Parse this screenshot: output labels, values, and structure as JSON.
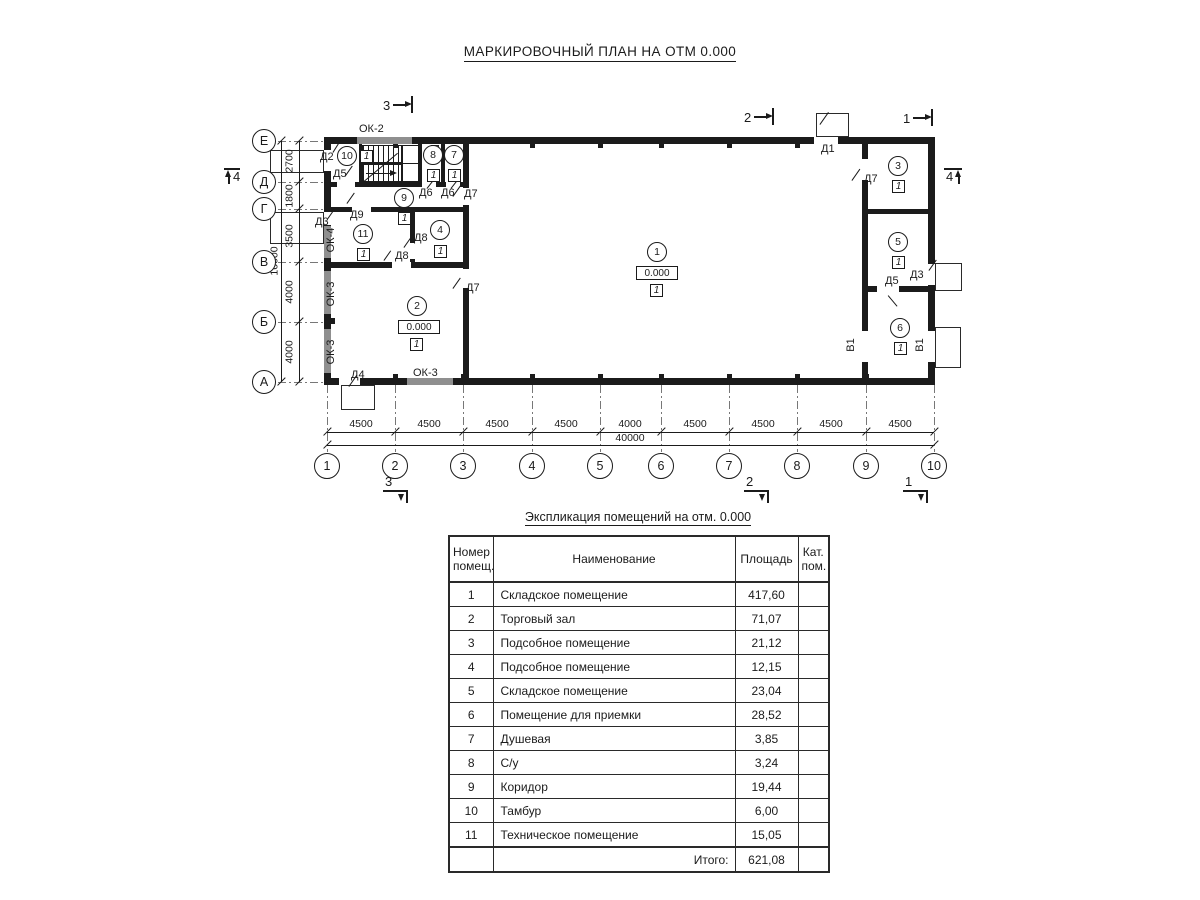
{
  "plan": {
    "title": "МАРКИРОВОЧНЫЙ ПЛАН НА ОТМ 0.000",
    "axes_rows": [
      {
        "label": "Е",
        "y": 141
      },
      {
        "label": "Д",
        "y": 182
      },
      {
        "label": "Г",
        "y": 209
      },
      {
        "label": "В",
        "y": 262
      },
      {
        "label": "Б",
        "y": 322
      },
      {
        "label": "А",
        "y": 382
      }
    ],
    "axes_cols": [
      {
        "label": "1",
        "x": 327
      },
      {
        "label": "2",
        "x": 395
      },
      {
        "label": "3",
        "x": 463
      },
      {
        "label": "4",
        "x": 532
      },
      {
        "label": "5",
        "x": 600
      },
      {
        "label": "6",
        "x": 661
      },
      {
        "label": "7",
        "x": 729
      },
      {
        "label": "8",
        "x": 797
      },
      {
        "label": "9",
        "x": 866
      },
      {
        "label": "10",
        "x": 934
      }
    ],
    "walls": [
      [
        324,
        137,
        611,
        7
      ],
      [
        324,
        378,
        611,
        7
      ],
      [
        324,
        137,
        7,
        248
      ],
      [
        928,
        137,
        7,
        248
      ],
      [
        463,
        137,
        6,
        248
      ],
      [
        862,
        137,
        6,
        248
      ],
      [
        324,
        182,
        145,
        5
      ],
      [
        324,
        207,
        145,
        5
      ],
      [
        324,
        262,
        145,
        6
      ],
      [
        410,
        212,
        5,
        50
      ],
      [
        418,
        143,
        4,
        39
      ],
      [
        441,
        143,
        4,
        39
      ],
      [
        359,
        143,
        3,
        39
      ],
      [
        862,
        209,
        73,
        5
      ],
      [
        862,
        286,
        73,
        6
      ]
    ],
    "windows": [
      [
        357,
        137,
        55,
        7
      ],
      [
        324,
        226,
        7,
        32
      ],
      [
        324,
        271,
        7,
        43
      ],
      [
        324,
        329,
        7,
        44
      ],
      [
        407,
        378,
        46,
        7
      ]
    ],
    "door_gaps": [
      [
        324,
        150,
        7,
        21
      ],
      [
        324,
        212,
        7,
        13
      ],
      [
        339,
        378,
        21,
        7
      ],
      [
        814,
        137,
        24,
        7
      ],
      [
        928,
        264,
        7,
        21
      ],
      [
        928,
        331,
        7,
        31
      ],
      [
        862,
        331,
        6,
        31
      ],
      [
        862,
        159,
        6,
        21
      ],
      [
        877,
        286,
        22,
        6
      ],
      [
        463,
        188,
        6,
        17
      ],
      [
        463,
        269,
        6,
        19
      ],
      [
        410,
        243,
        5,
        16
      ],
      [
        392,
        262,
        19,
        6
      ],
      [
        352,
        207,
        19,
        5
      ],
      [
        337,
        182,
        18,
        5
      ],
      [
        422,
        182,
        14,
        5
      ],
      [
        446,
        182,
        14,
        5
      ]
    ],
    "porches": [
      [
        270,
        150,
        54,
        23
      ],
      [
        270,
        212,
        54,
        32
      ],
      [
        341,
        385,
        34,
        25
      ],
      [
        816,
        113,
        33,
        24
      ],
      [
        935,
        263,
        27,
        28
      ],
      [
        935,
        327,
        26,
        41
      ]
    ],
    "fixtures": [
      [
        431,
        145,
        8,
        10
      ]
    ],
    "pilasters": [
      [
        393,
        144,
        5,
        4
      ],
      [
        530,
        144,
        5,
        4
      ],
      [
        598,
        144,
        5,
        4
      ],
      [
        659,
        144,
        5,
        4
      ],
      [
        727,
        144,
        5,
        4
      ],
      [
        795,
        144,
        5,
        4
      ],
      [
        393,
        374,
        5,
        4
      ],
      [
        461,
        374,
        5,
        4
      ],
      [
        530,
        374,
        5,
        4
      ],
      [
        598,
        374,
        5,
        4
      ],
      [
        659,
        374,
        5,
        4
      ],
      [
        727,
        374,
        5,
        4
      ],
      [
        795,
        374,
        5,
        4
      ],
      [
        864,
        374,
        5,
        4
      ],
      [
        331,
        318,
        4,
        6
      ]
    ],
    "leaves": [
      [
        333,
        152,
        15,
        -58
      ],
      [
        345,
        176,
        13,
        -55
      ],
      [
        347,
        203,
        13,
        -55
      ],
      [
        328,
        218,
        12,
        -55
      ],
      [
        404,
        247,
        12,
        -55
      ],
      [
        384,
        260,
        12,
        -55
      ],
      [
        427,
        188,
        11,
        -52
      ],
      [
        451,
        188,
        11,
        -52
      ],
      [
        453,
        196,
        13,
        -55
      ],
      [
        453,
        288,
        13,
        -55
      ],
      [
        349,
        386,
        14,
        -55
      ],
      [
        820,
        124,
        15,
        -55
      ],
      [
        852,
        180,
        14,
        -55
      ],
      [
        929,
        270,
        13,
        -55
      ],
      [
        888,
        295,
        14,
        50
      ],
      [
        364,
        181,
        44,
        -40
      ]
    ],
    "labels": [
      {
        "text": "Д2",
        "x": 320,
        "y": 151
      },
      {
        "text": "Д5",
        "x": 333,
        "y": 168
      },
      {
        "text": "Д9",
        "x": 350,
        "y": 209
      },
      {
        "text": "Д3",
        "x": 315,
        "y": 216
      },
      {
        "text": "Д4",
        "x": 351,
        "y": 369
      },
      {
        "text": "Д1",
        "x": 821,
        "y": 143
      },
      {
        "text": "Д7",
        "x": 464,
        "y": 188
      },
      {
        "text": "Д7",
        "x": 466,
        "y": 282
      },
      {
        "text": "Д7",
        "x": 864,
        "y": 173
      },
      {
        "text": "Д8",
        "x": 414,
        "y": 232
      },
      {
        "text": "Д8",
        "x": 395,
        "y": 250
      },
      {
        "text": "Д6",
        "x": 419,
        "y": 187
      },
      {
        "text": "Д6",
        "x": 441,
        "y": 187
      },
      {
        "text": "Д5",
        "x": 885,
        "y": 275
      },
      {
        "text": "Д3",
        "x": 910,
        "y": 269
      },
      {
        "text": "ОК-2",
        "x": 359,
        "y": 123
      },
      {
        "text": "ОК-3",
        "x": 413,
        "y": 367
      },
      {
        "text": "ОК-4",
        "x": 331,
        "y": 240,
        "rot": -90
      },
      {
        "text": "ОК-3",
        "x": 331,
        "y": 294,
        "rot": -90
      },
      {
        "text": "ОК-3",
        "x": 331,
        "y": 352,
        "rot": -90
      },
      {
        "text": "В1",
        "x": 851,
        "y": 345,
        "rot": -90
      },
      {
        "text": "В1",
        "x": 920,
        "y": 345,
        "rot": -90
      }
    ],
    "rooms": [
      {
        "num": "1",
        "cat": "1",
        "cx": 657,
        "cy": 252,
        "elev": "0.000",
        "ex": 636,
        "ey": 266,
        "sx": 650,
        "sy": 284
      },
      {
        "num": "2",
        "cat": "1",
        "cx": 417,
        "cy": 306,
        "elev": "0.000",
        "ex": 398,
        "ey": 320,
        "sx": 410,
        "sy": 338
      },
      {
        "num": "3",
        "cat": "1",
        "cx": 898,
        "cy": 166,
        "sx": 892,
        "sy": 180
      },
      {
        "num": "4",
        "cat": "1",
        "cx": 440,
        "cy": 230,
        "sx": 434,
        "sy": 245
      },
      {
        "num": "5",
        "cat": "1",
        "cx": 898,
        "cy": 242,
        "sx": 892,
        "sy": 256
      },
      {
        "num": "6",
        "cat": "1",
        "cx": 900,
        "cy": 328,
        "sx": 894,
        "sy": 342
      },
      {
        "num": "7",
        "cat": "1",
        "cx": 454,
        "cy": 155,
        "sx": 448,
        "sy": 169
      },
      {
        "num": "8",
        "cat": "1",
        "cx": 433,
        "cy": 155,
        "sx": 427,
        "sy": 169
      },
      {
        "num": "9",
        "cat": "1",
        "cx": 404,
        "cy": 198,
        "sx": 398,
        "sy": 212
      },
      {
        "num": "10",
        "cat": "1",
        "cx": 347,
        "cy": 156,
        "sx": 360,
        "sy": 150
      },
      {
        "num": "11",
        "cat": "1",
        "cx": 363,
        "cy": 234,
        "sx": 357,
        "sy": 248
      }
    ],
    "sections": [
      {
        "num": "3",
        "type": "top",
        "x": 383,
        "y": 96
      },
      {
        "num": "2",
        "type": "top",
        "x": 744,
        "y": 108
      },
      {
        "num": "1",
        "type": "top",
        "x": 903,
        "y": 109
      },
      {
        "num": "3",
        "type": "bottom",
        "x": 383,
        "y": 475
      },
      {
        "num": "2",
        "type": "bottom",
        "x": 744,
        "y": 475
      },
      {
        "num": "1",
        "type": "bottom",
        "x": 903,
        "y": 475
      },
      {
        "num": "4",
        "type": "left",
        "x": 224,
        "y": 166
      },
      {
        "num": "4",
        "type": "right",
        "x": 944,
        "y": 166
      }
    ],
    "dims_bottom": {
      "y": 432,
      "ty": 419,
      "x1": 327,
      "x2": 934,
      "labels": [
        {
          "text": "4500",
          "mid": 361
        },
        {
          "text": "4500",
          "mid": 429
        },
        {
          "text": "4500",
          "mid": 497
        },
        {
          "text": "4500",
          "mid": 566
        },
        {
          "text": "4000",
          "mid": 630
        },
        {
          "text": "4500",
          "mid": 695
        },
        {
          "text": "4500",
          "mid": 763
        },
        {
          "text": "4500",
          "mid": 831
        },
        {
          "text": "4500",
          "mid": 900
        }
      ]
    },
    "dim_overall_bottom": {
      "text": "40000",
      "y": 445,
      "x1": 327,
      "x2": 934,
      "tx": 630,
      "ty": 433
    },
    "dims_left": {
      "x": 299,
      "tx": 290,
      "y1": 141,
      "y2": 382,
      "labels": [
        {
          "text": "2700",
          "mid": 161
        },
        {
          "text": "1800",
          "mid": 196
        },
        {
          "text": "3500",
          "mid": 236
        },
        {
          "text": "4000",
          "mid": 292
        },
        {
          "text": "4000",
          "mid": 352
        }
      ]
    },
    "dim_overall_left": {
      "text": "16000",
      "x": 281,
      "y1": 141,
      "y2": 382,
      "tx": 275,
      "tmid": 261
    },
    "stairs": {
      "x": 362,
      "y": 144
    }
  },
  "table": {
    "title": "Экспликация помещений на отм. 0.000",
    "headers": [
      "Номер\nпомещ.",
      "Наименование",
      "Площадь",
      "Кат.\nпом."
    ],
    "col_widths": [
      44,
      242,
      63,
      31
    ],
    "rows": [
      [
        "1",
        "Складское помещение",
        "417,60",
        ""
      ],
      [
        "2",
        "Торговый зал",
        "71,07",
        ""
      ],
      [
        "3",
        "Подсобное помещение",
        "21,12",
        ""
      ],
      [
        "4",
        "Подсобное помещение",
        "12,15",
        ""
      ],
      [
        "5",
        "Складское помещение",
        "23,04",
        ""
      ],
      [
        "6",
        "Помещение для приемки",
        "28,52",
        ""
      ],
      [
        "7",
        "Душевая",
        "3,85",
        ""
      ],
      [
        "8",
        "С/у",
        "3,24",
        ""
      ],
      [
        "9",
        "Коридор",
        "19,44",
        ""
      ],
      [
        "10",
        "Тамбур",
        "6,00",
        ""
      ],
      [
        "11",
        "Техническое помещение",
        "15,05",
        ""
      ]
    ],
    "total_label": "Итого:",
    "total_value": "621,08"
  }
}
